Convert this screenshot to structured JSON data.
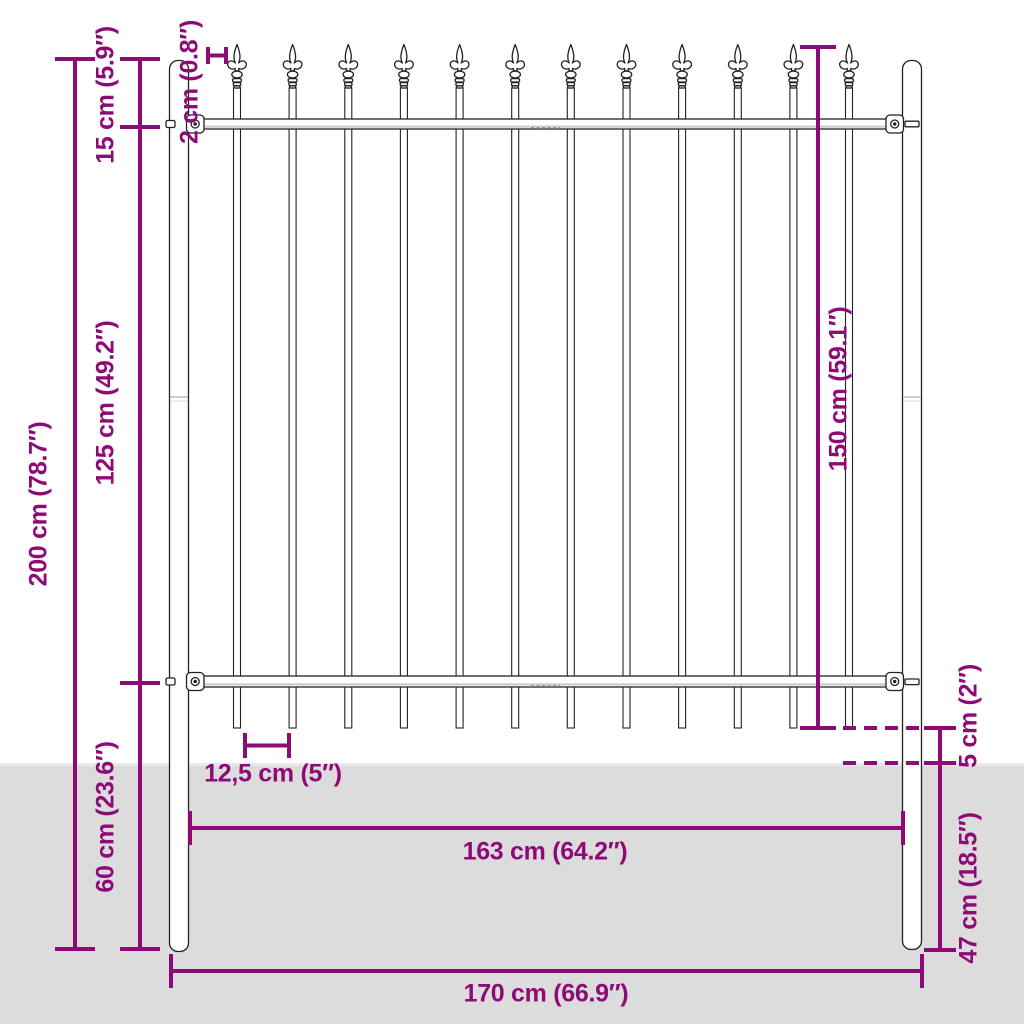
{
  "colors": {
    "dimension_magenta": "#8e0b77",
    "fence_outline": "#222222",
    "ground_gray": "#dcdcdc",
    "background": "#ffffff"
  },
  "fence": {
    "bar_count": 12,
    "post_count": 2,
    "rail_count": 2,
    "finial": "spear",
    "layout": {
      "first_bar_x": 237,
      "bar_pitch": 55.64
    }
  },
  "dimensions": {
    "overall_height": "200 cm (78.7″)",
    "spear_height": "15 cm (5.9″)",
    "bar_diameter": "2 cm (0.8″)",
    "between_rails": "125 cm (49.2″)",
    "infill_height": "150 cm (59.1″)",
    "below_bottom_rail": "60 cm (23.6″)",
    "bar_spacing": "12,5 cm (5″)",
    "bar_above_ground": "5 cm (2″)",
    "post_depth": "47 cm (18.5″)",
    "inner_width": "163 cm (64.2″)",
    "overall_width": "170 cm (66.9″)"
  }
}
